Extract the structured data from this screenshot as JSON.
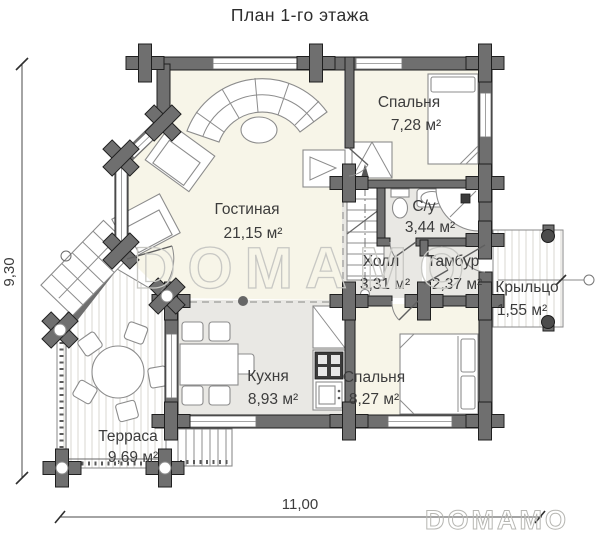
{
  "title": "План 1-го этажа",
  "watermark": {
    "text": "DOMAMO"
  },
  "dimensions": {
    "height_label": "9,30",
    "width_label": "11,00"
  },
  "rooms": [
    {
      "id": "bedroom1",
      "name": "Спальня",
      "area": "7,28 м²"
    },
    {
      "id": "living",
      "name": "Гостиная",
      "area": "21,15 м²"
    },
    {
      "id": "bathroom",
      "name": "С/у",
      "area": "3,44 м²"
    },
    {
      "id": "hall",
      "name": "Холл",
      "area": "3,31 м²"
    },
    {
      "id": "tambour",
      "name": "Тамбур",
      "area": "2,37 м²"
    },
    {
      "id": "porch",
      "name": "Крыльцо",
      "area": "1,55 м²"
    },
    {
      "id": "kitchen",
      "name": "Кухня",
      "area": "8,93 м²"
    },
    {
      "id": "bedroom2",
      "name": "Спальня",
      "area": "8,27 м²"
    },
    {
      "id": "terrace",
      "name": "Терраса",
      "area": "9,69 м²"
    }
  ],
  "colors": {
    "background": "#ffffff",
    "wall": "#6f6f6f",
    "wall_edge": "#1f1f1f",
    "floor_warm": "#f7f5e8",
    "floor_cool": "#e9e8e4",
    "stripe": "#d8d7d2",
    "text": "#3c3c3c",
    "watermark": "#c8c8c4"
  }
}
